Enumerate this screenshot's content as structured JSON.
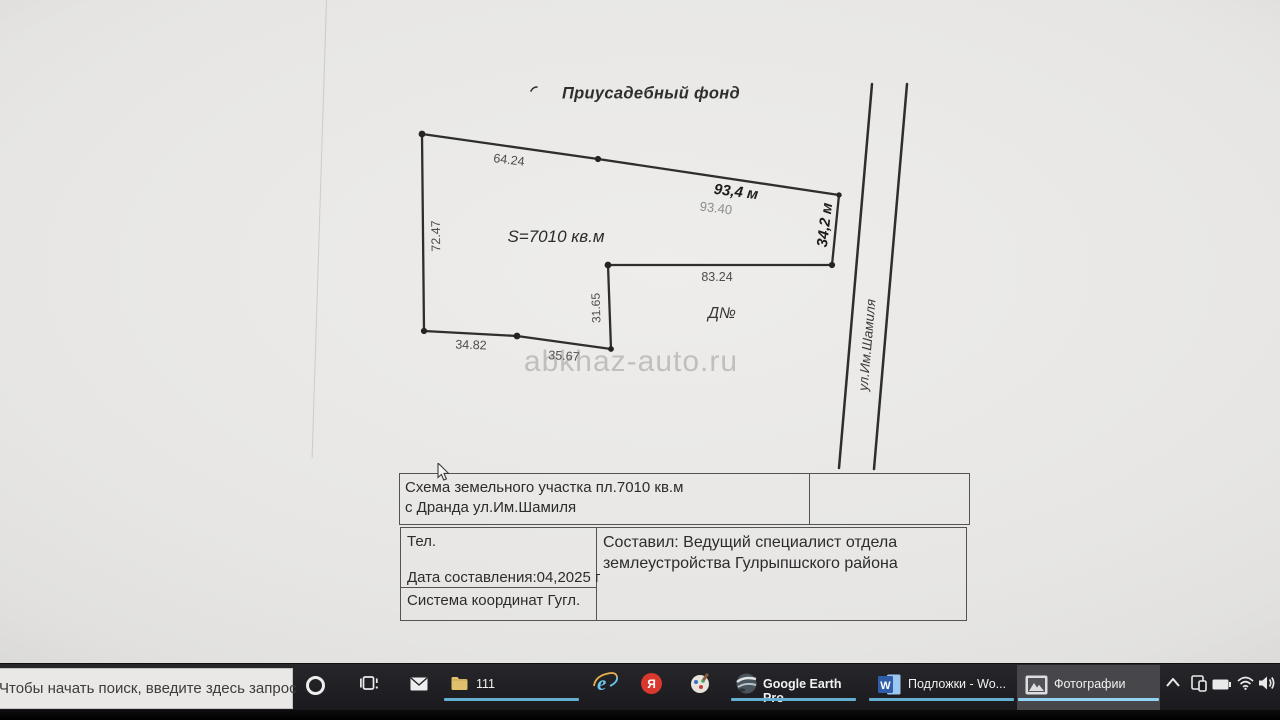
{
  "document": {
    "title": "Приусадебный фонд",
    "area": "S=7010 кв.м",
    "plot_no": "Д№",
    "street": "ул.Им.Шамиля",
    "watermark": "abkhaz-auto.ru",
    "dims": {
      "d6424": "64.24",
      "d934m": "93,4 м",
      "d9340": "93.40",
      "d342m": "34,2 м",
      "d7247": "72.47",
      "d8324": "83.24",
      "d3165": "31.65",
      "d3482": "34.82",
      "d3567": "35.67"
    },
    "table": {
      "scheme_line1": "Схема земельного участка пл.7010 кв.м",
      "scheme_line2": "с Дранда ул.Им.Шамиля",
      "tel": "Тел.",
      "date": "Дата составления:04,2025 г",
      "coords": "Система координат Гугл.",
      "author_line1": "Составил: Ведущий специалист отдела",
      "author_line2": "землеустройства Гулрыпшского района"
    }
  },
  "taskbar": {
    "search_text": "Чтобы начать поиск, введите здесь запрос",
    "apps": {
      "folder": "111",
      "google_earth": "Google Earth Pro",
      "word": "Подложки - Wo...",
      "photos": "Фотографии",
      "yandex_letter": "Я",
      "ie_letter": "e",
      "word_letter": "W"
    },
    "icons": {
      "cortana-icon": "ring",
      "task-view-icon": "film-frames",
      "mail-icon": "envelope",
      "folder-icon": "yellow-folder",
      "ie-icon": "blue-e",
      "yandex-icon": "red-circle-ya",
      "paint3d-icon": "palette",
      "google-earth-icon": "globe",
      "word-icon": "blue-w-square",
      "photos-icon": "mountain-photo",
      "tray-chevron-icon": "chevron-up",
      "tray-device-icon": "device",
      "tray-battery-icon": "battery",
      "tray-wifi-icon": "wifi",
      "tray-volume-icon": "speaker"
    },
    "colors": {
      "bar": "#1e1e22",
      "search_bg": "#e9e8e6",
      "underline": "#64aed2",
      "underline_active": "#92d4f4",
      "active_button_bg": "#47474b",
      "yandex_red": "#d8382d",
      "ie_blue": "#6cc6ee",
      "folder_yellow": "#dfc06c",
      "word_blue": "#2f5da8"
    }
  }
}
